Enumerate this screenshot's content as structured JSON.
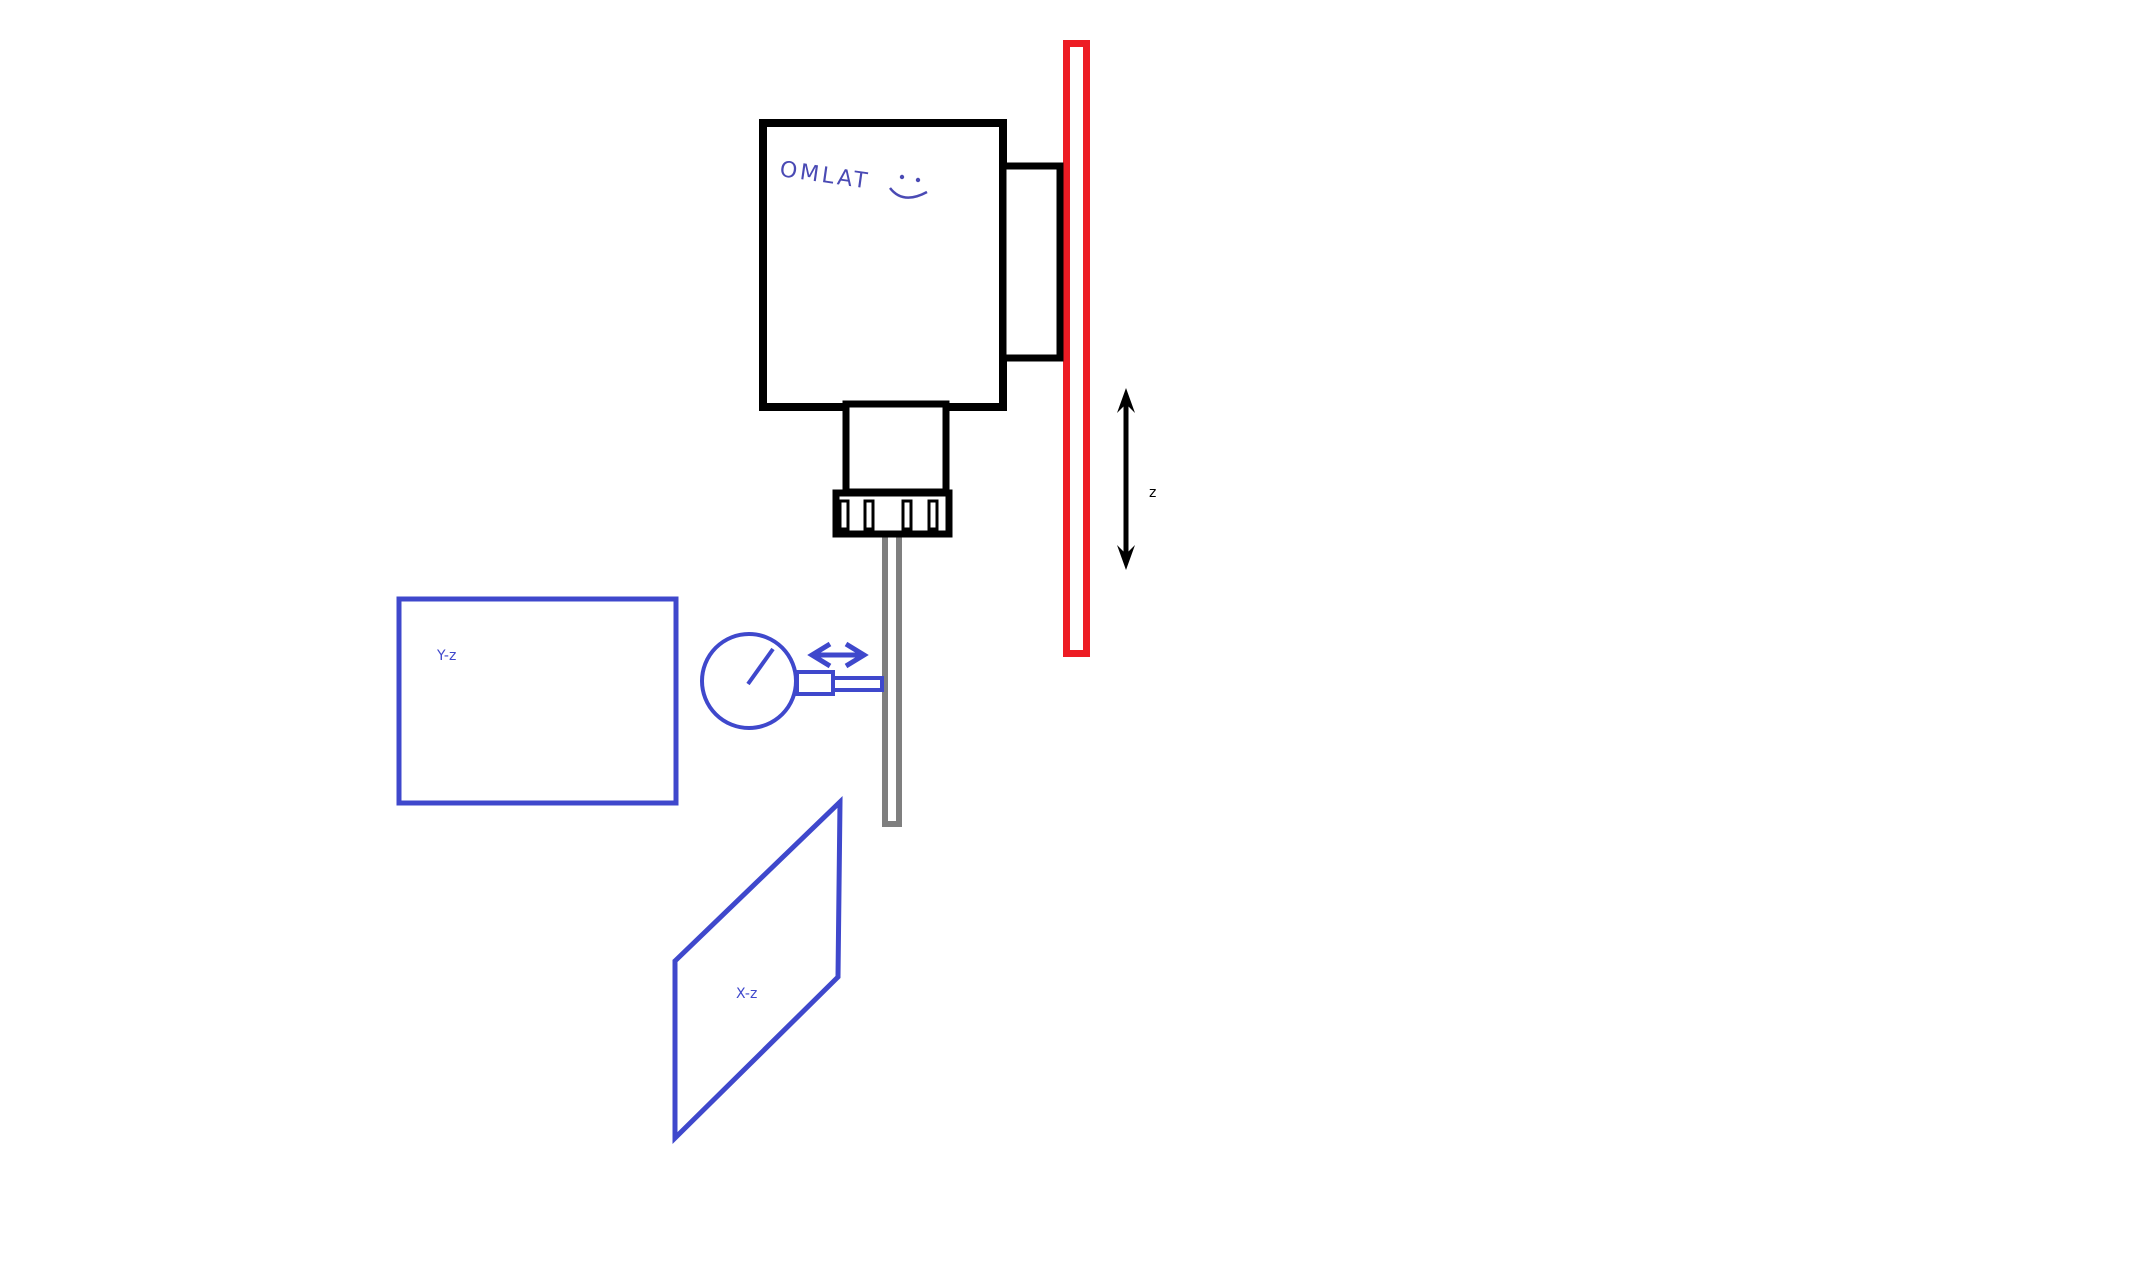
{
  "canvas": {
    "width": 2133,
    "height": 1282,
    "description": "hand-drawn paint sketch of spindle runout measurement setup"
  },
  "colors": {
    "background": "#ffffff",
    "outline": "#000000",
    "blue": "#3F48CC",
    "red": "#ED1C24",
    "gray": "#7F7F7F",
    "ink": "#4A4AB4"
  },
  "labels": {
    "spindle_brand": "OMLAT",
    "z_axis": "z",
    "yz_plane": "Y-z",
    "xz_plane": "X-z"
  },
  "icons": {
    "smiley": "smiley-face-icon",
    "z_arrow": "vertical-double-arrow-icon",
    "sweep_arrow": "horizontal-double-arrow-icon"
  }
}
